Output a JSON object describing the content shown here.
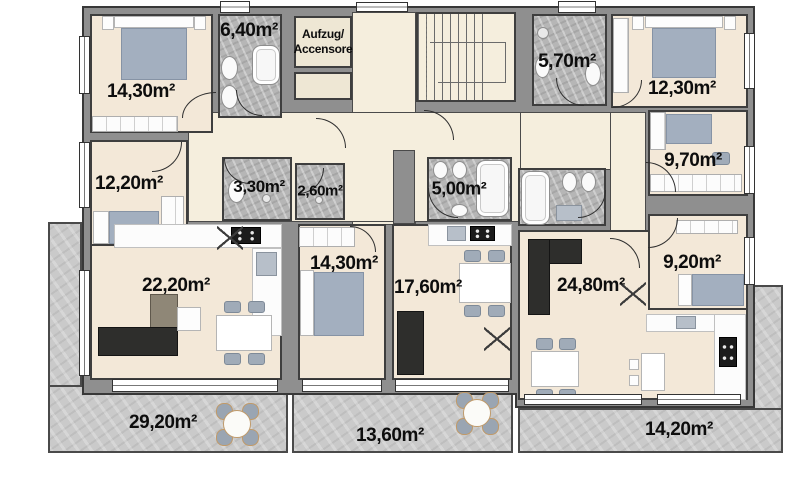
{
  "plan": {
    "elevator": {
      "line1": "Aufzug/",
      "line2": "Accensore"
    },
    "areas": {
      "bedroom_14_30": "14,30m²",
      "bath_6_40": "6,40m²",
      "bath_5_70": "5,70m²",
      "bedroom_12_30": "12,30m²",
      "bedroom_12_20": "12,20m²",
      "wc_3_30": "3,30m²",
      "shower_2_60": "2,60m²",
      "bath_5_00": "5,00m²",
      "bedroom_9_70": "9,70m²",
      "bedroom_9_20": "9,20m²",
      "living_22_20": "22,20m²",
      "room_14_30": "14,30m²",
      "room_17_60": "17,60m²",
      "living_24_80": "24,80m²",
      "terrace_29_20": "29,20m²",
      "terrace_13_60": "13,60m²",
      "terrace_14_20": "14,20m²"
    },
    "colors": {
      "wall": "#8f8f8f",
      "wall_outline": "#383838",
      "floor_hall": "#f5eedd",
      "floor_room": "#f3e8d8",
      "bath_floor": "#b6b6b6",
      "terrace_floor": "#cacaca",
      "furniture_blue": "#a3afbf",
      "sofa_dark": "#2e2e2c",
      "sofa_beige": "#8f8777",
      "label_color": "#0d0d0d"
    }
  }
}
